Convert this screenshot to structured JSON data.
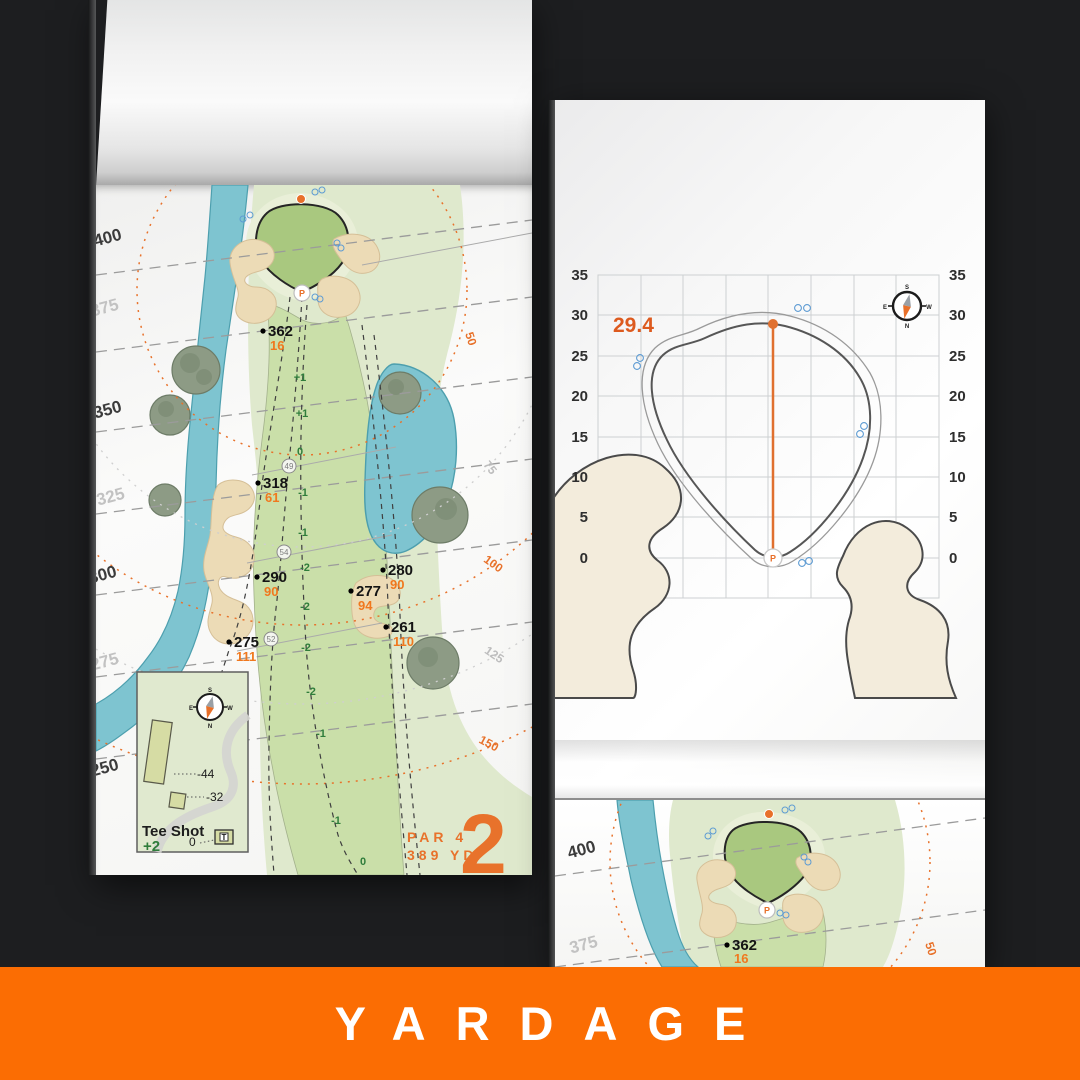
{
  "banner": {
    "label": "YARDAGE",
    "bg_color": "#fb6d03",
    "text_color": "#ffffff"
  },
  "colors": {
    "accent_orange": "#e8722b",
    "background": "#1d1e20",
    "water": "#7ec4d0",
    "sand": "#ecdbb6",
    "green_fill": "#a9c87f",
    "carry_orange": "#f0781e"
  },
  "left_page": {
    "hole": {
      "par_label": "PAR 4",
      "yards_label": "389 YD",
      "number": "2"
    },
    "distance_labels": [
      "400",
      "375",
      "350",
      "325",
      "300",
      "275",
      "250"
    ],
    "ring_labels": [
      "50",
      "75",
      "100",
      "125",
      "150"
    ],
    "markers": [
      {
        "distance": "362",
        "carry": "16"
      },
      {
        "distance": "318",
        "carry": "61"
      },
      {
        "distance": "290",
        "carry": "90"
      },
      {
        "distance": "275",
        "carry": "111"
      },
      {
        "distance": "280",
        "carry": "90"
      },
      {
        "distance": "277",
        "carry": "94"
      },
      {
        "distance": "261",
        "carry": "110"
      }
    ],
    "elevations": [
      "+1",
      "+1",
      "0",
      "-1",
      "-1",
      "-2",
      "-2",
      "-2",
      "-2",
      "-1",
      "-1",
      "0"
    ],
    "width_markers": [
      "49",
      "54",
      "52"
    ],
    "pin_label": "P",
    "inset": {
      "title": "Tee Shot",
      "value": "+2",
      "tee_back": "-44",
      "tee_front": "-32",
      "tee_zero": "0",
      "tee_icon": "T"
    },
    "compass": {
      "n": "N",
      "s": "S",
      "e": "E",
      "w": "W"
    }
  },
  "green_page": {
    "depth_value": "29.4",
    "axis_labels": [
      "35",
      "30",
      "25",
      "20",
      "15",
      "10",
      "5",
      "0"
    ],
    "pin_label": "P",
    "compass": {
      "n": "N",
      "s": "S",
      "e": "E",
      "w": "W"
    }
  },
  "next_page": {
    "distance_labels": [
      "400",
      "375"
    ],
    "ring_label": "50",
    "marker": {
      "distance": "362",
      "carry": "16"
    },
    "pin_label": "P"
  }
}
